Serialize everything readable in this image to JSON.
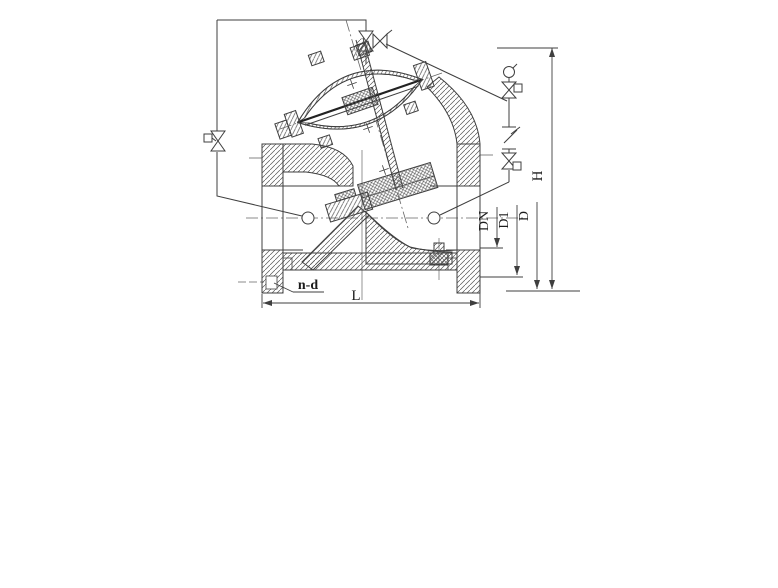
{
  "diagram": {
    "kind": "valve-cross-section-drawing",
    "labels": {
      "dn": "DN",
      "d1": "D1",
      "d": "D",
      "h": "H",
      "l": "L",
      "n_d": "n-d"
    },
    "colors": {
      "line": "#3f3f3f",
      "background": "#ffffff"
    }
  }
}
